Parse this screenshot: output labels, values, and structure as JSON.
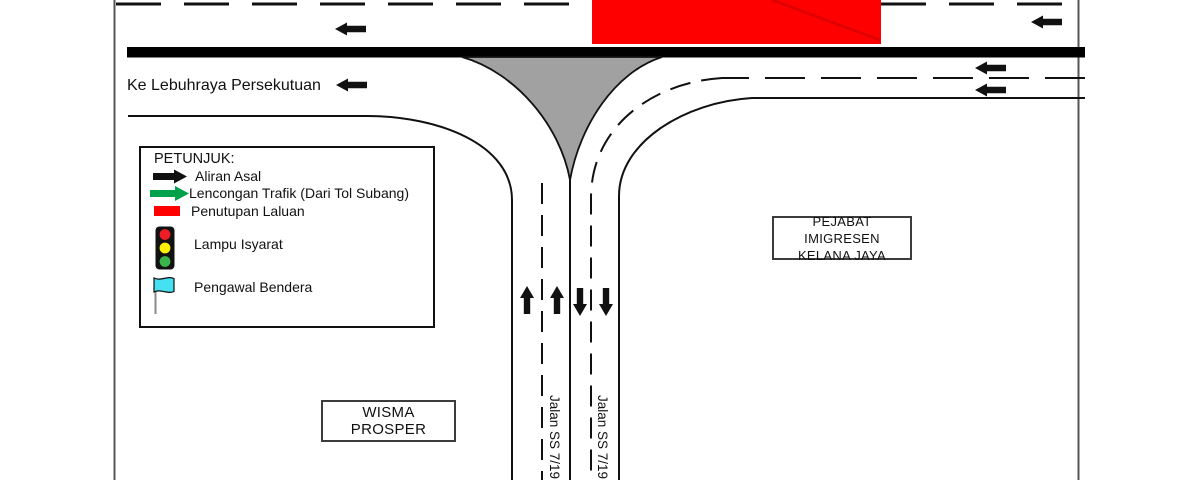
{
  "colors": {
    "closure_red": "#ff0000",
    "closure_stripe": "#e00000",
    "island_gray": "#a1a1a1",
    "diversion_green": "#00a14b",
    "signal_red": "#ee1c25",
    "signal_yellow": "#ffee00",
    "signal_green": "#3ab54a",
    "flag_cyan": "#45e1f2"
  },
  "labels": {
    "to_federal_highway": "Ke Lebuhraya Persekutuan",
    "immigration_office_line1": "PEJABAT IMIGRESEN",
    "immigration_office_line2": "KELANA JAYA",
    "wisma_prosper": "WISMA PROSPER",
    "road_name_left": "Jalan SS 7/19",
    "road_name_right": "Jalan SS 7/19"
  },
  "legend": {
    "title": "PETUNJUK:",
    "items": [
      {
        "icon": "black-arrow-icon",
        "label": "Aliran Asal"
      },
      {
        "icon": "green-arrow-icon",
        "label": "Lencongan Trafik (Dari Tol Subang)"
      },
      {
        "icon": "closure-swatch-icon",
        "label": "Penutupan Laluan"
      },
      {
        "icon": "traffic-light-icon",
        "label": "Lampu Isyarat"
      },
      {
        "icon": "flag-icon",
        "label": "Pengawal Bendera"
      }
    ]
  }
}
